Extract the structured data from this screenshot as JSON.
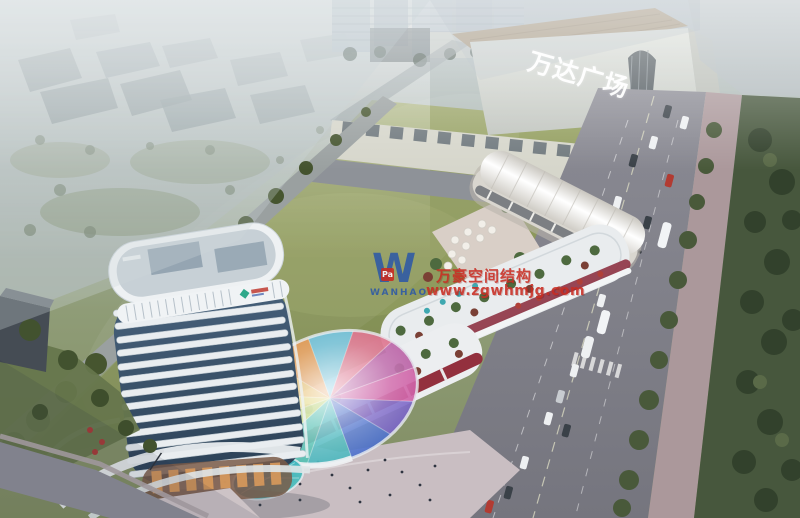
{
  "scene": {
    "alt": "Aerial architectural rendering of a mixed-use complex: curved high-rise tower, rainbow glass dome canopy, retail terraces, green field, Wanda Plaza mall and tree-lined roads"
  },
  "mall_sign": {
    "text": "万达广场"
  },
  "watermark": {
    "logo_letter": "W",
    "logo_badge": "Pa",
    "company_en": "WANHAO",
    "company_cn": "万豪空间结构",
    "url": "www.zgwhmjg.com",
    "text_color": "#c92c22",
    "logo_color": "#2a57a8"
  },
  "colors": {
    "haze": "#b7c2c8",
    "field_green": "#93a05f",
    "park_green": "#47573d",
    "road_gray": "#8b8b94",
    "tower_band": "#e7ebee",
    "tower_glass": "#3a5068",
    "mall_roof": "#a6906f",
    "accent_red": "#93303e",
    "umbrella_teal": "#3fa8b0",
    "umbrella_red": "#b04038",
    "dome_palette": [
      "#c84a9a",
      "#6a52c0",
      "#3a62c8",
      "#38b0b8",
      "#3cb8a8",
      "#a8c84e",
      "#d8c84a",
      "#e0a838",
      "#e08838",
      "#58b8d8",
      "#d85878",
      "#b04898"
    ]
  }
}
